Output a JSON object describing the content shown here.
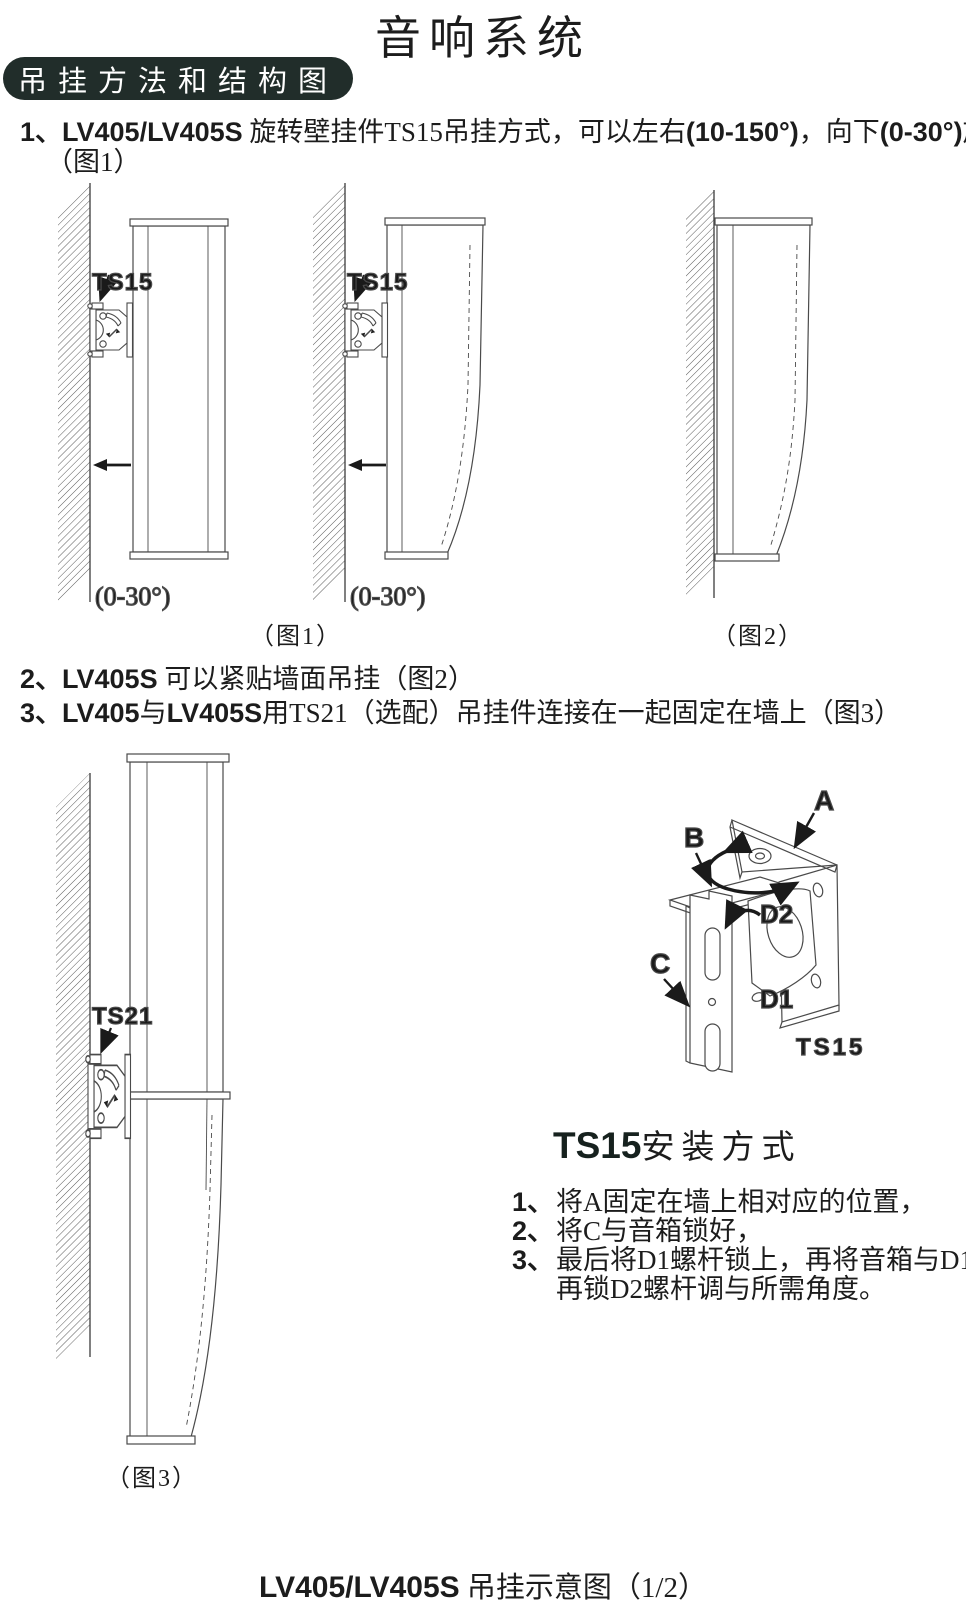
{
  "title": "音响系统",
  "badge": "吊挂方法和结构图",
  "items": {
    "i1": {
      "num": "1、",
      "model": "LV405/LV405S",
      "seg1": " 旋转壁挂件TS15吊挂方式，可以左右",
      "angle1": "(10-150°)",
      "seg2": "，向下",
      "angle2": "(0-30°)",
      "seg3": "旋转角度。",
      "cont": "（图1）"
    },
    "i2": {
      "num": "2、",
      "model": "LV405S",
      "text": " 可以紧贴墙面吊挂（图2）"
    },
    "i3": {
      "num": "3、",
      "modelA": "LV405",
      "conj": "与",
      "modelB": "LV405S",
      "text": "用TS21（选配）吊挂件连接在一起固定在墙上（图3）"
    }
  },
  "fig1": {
    "ts15_left": "TS15",
    "ts15_right": "TS15",
    "angle_left": "(0-30°)",
    "angle_right": "(0-30°)",
    "caption": "（图1）"
  },
  "fig2": {
    "caption": "（图2）"
  },
  "fig3": {
    "ts21": "TS21",
    "caption": "（图3）"
  },
  "detail": {
    "a": "A",
    "b": "B",
    "c": "C",
    "d2": "D2",
    "d1": "D1",
    "label": "TS15"
  },
  "install": {
    "heading_bold": "TS15",
    "heading_rest": "安装方式",
    "steps": [
      {
        "num": "1、",
        "text": "将A固定在墙上相对应的位置，"
      },
      {
        "num": "2、",
        "text": "将C与音箱锁好，"
      },
      {
        "num": "3、",
        "text": "最后将D1螺杆锁上，再将音箱与D1卡住，"
      },
      {
        "num": "",
        "text": "再锁D2螺杆调与所需角度。"
      }
    ]
  },
  "footer": {
    "model": "LV405/LV405S",
    "text": " 吊挂示意图（1/2）"
  },
  "colors": {
    "badge_bg": "#212d2a",
    "ink": "#1c1c1c",
    "line": "#4a4a4a"
  }
}
